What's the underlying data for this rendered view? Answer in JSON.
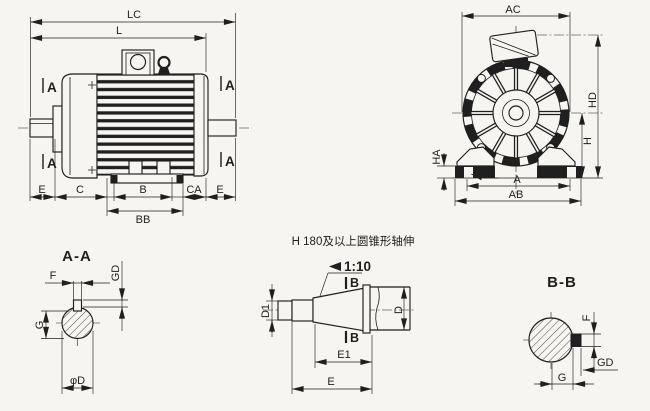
{
  "colors": {
    "ink": "#1f1f1f",
    "paper": "#f6f5f1"
  },
  "side_view": {
    "dim_lc": "LC",
    "dim_l": "L",
    "section_marker": "A",
    "dim_e_front": "E",
    "dim_c": "C",
    "dim_b": "B",
    "dim_ca": "CA",
    "dim_e_rear": "E",
    "dim_bb": "BB"
  },
  "end_view": {
    "dim_ac": "AC",
    "dim_hd": "HD",
    "dim_h": "H",
    "dim_ha": "HA",
    "dim_k": "K",
    "dim_a": "A",
    "dim_ab": "AB"
  },
  "section_aa": {
    "title": "A-A",
    "dim_f": "F",
    "dim_gd": "GD",
    "dim_g": "G",
    "dim_phi_d": "φD"
  },
  "taper_shaft": {
    "note": "H 180及以上圆锥形轴伸",
    "ratio": "1:10",
    "marker_b": "B",
    "dim_d1": "D1",
    "dim_d": "D",
    "dim_e1": "E1",
    "dim_e": "E"
  },
  "section_bb": {
    "title": "B-B",
    "dim_f": "F",
    "dim_gd": "GD",
    "dim_g": "G"
  }
}
